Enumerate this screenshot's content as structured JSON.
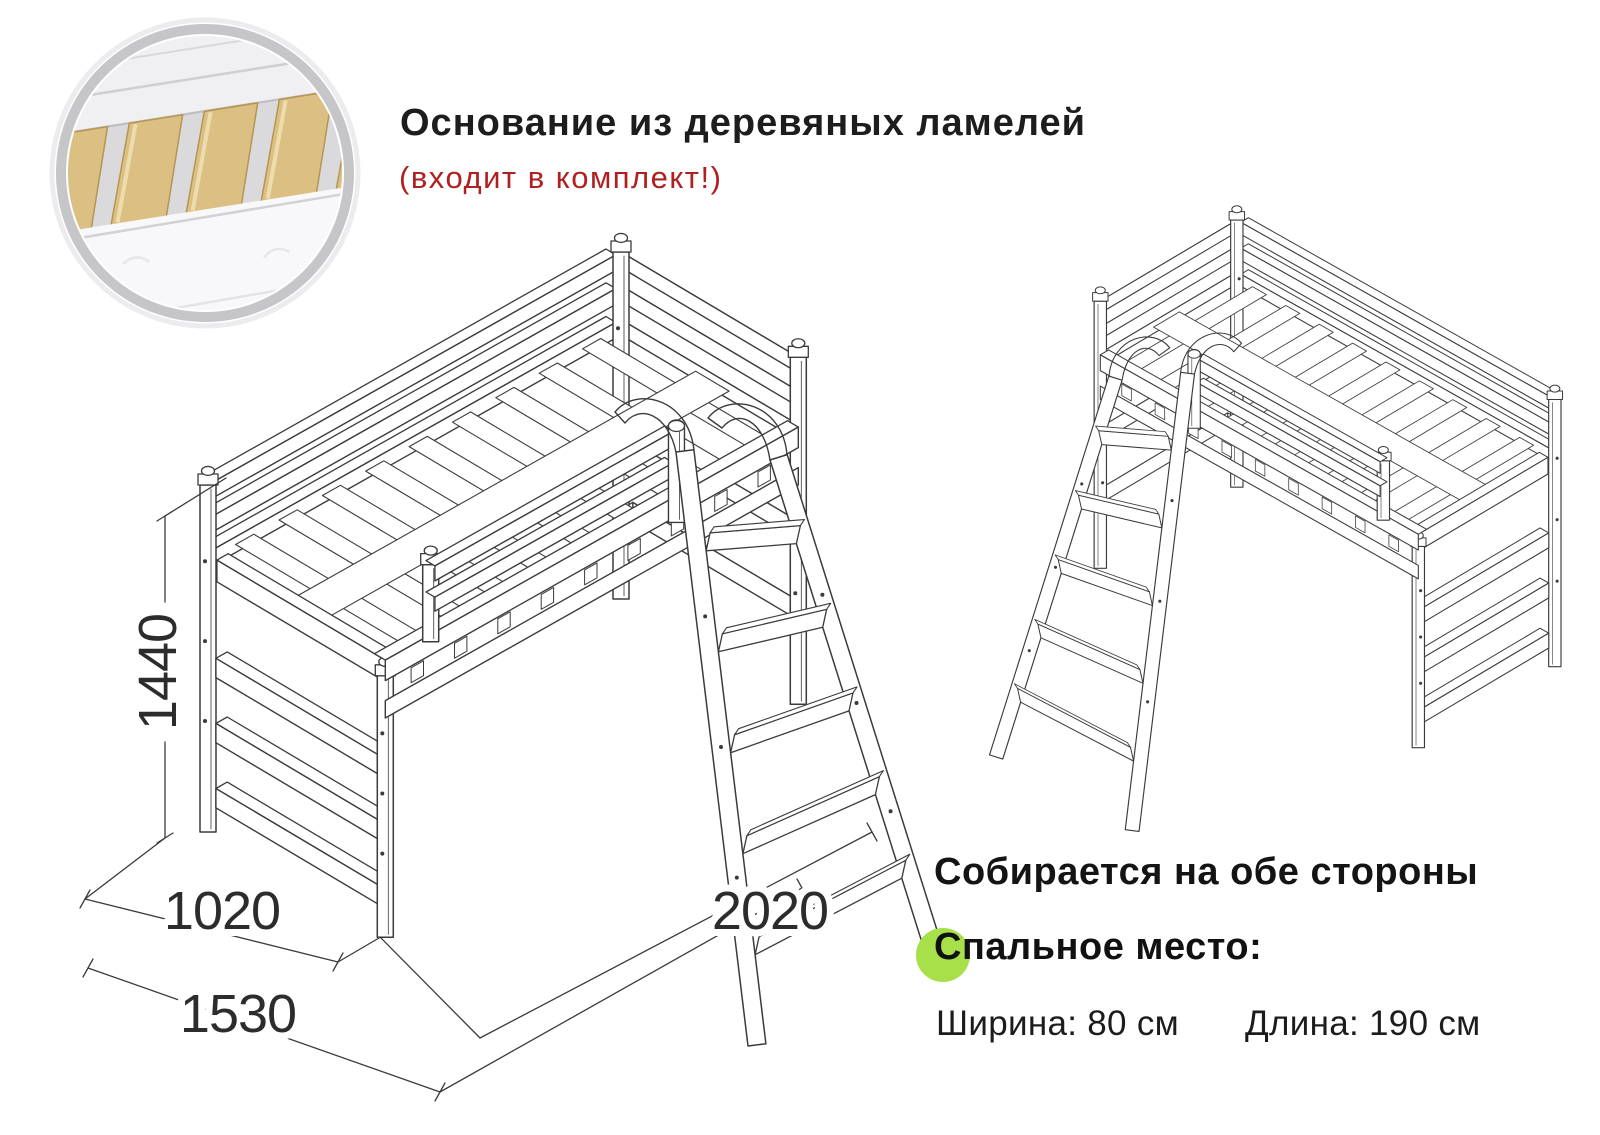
{
  "header": {
    "title": "Основание из деревяных ламелей",
    "subtitle": "(входит в комплект!)"
  },
  "dims": {
    "height": "1440",
    "width": "1020",
    "depth": "1530",
    "length": "2020"
  },
  "notes": {
    "both_sides": "Собирается на обе стороны"
  },
  "sleeping": {
    "heading": "Спальное место:",
    "width_spec": "Ширина: 80 см",
    "length_spec": "Длина: 190 см"
  },
  "colors": {
    "accent_green": "#a8e04a",
    "accent_red": "#b02020",
    "line": "#3b3b3b",
    "slat_wood": "#dcc083",
    "ring_gray": "#c6c6c9"
  }
}
